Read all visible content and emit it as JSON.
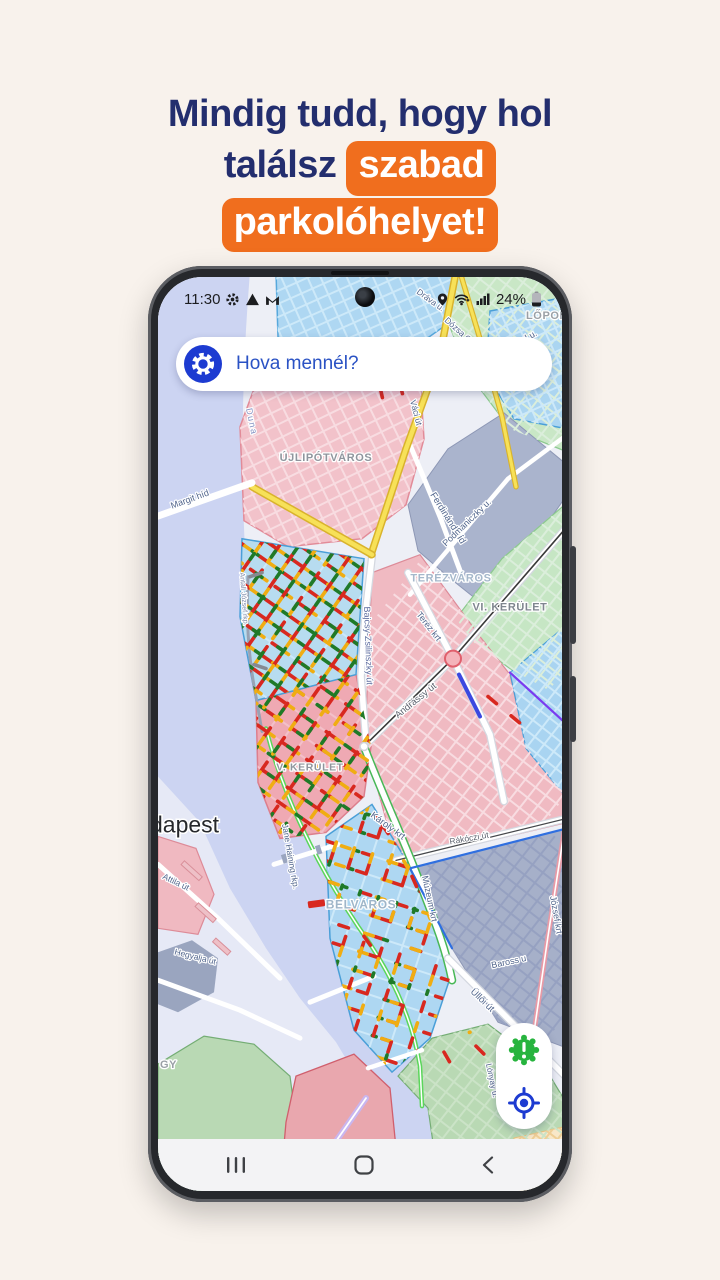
{
  "page": {
    "background": "#f8f2ec"
  },
  "headline": {
    "line1": "Mindig tudd, hogy hol",
    "line2_plain": "találsz",
    "line2_highlight": "szabad",
    "line3_highlight": "parkolóhelyet!",
    "text_color": "#232e6e",
    "highlight_bg": "#f06e1e",
    "highlight_text": "#ffffff"
  },
  "status_bar": {
    "time": "11:30",
    "battery_percent": "24%",
    "left_icons": [
      "gear-icon",
      "warning-icon",
      "gmail-icon"
    ],
    "right_icons": [
      "location-pin-icon",
      "wifi-icon",
      "signal-bars-icon",
      "battery-icon"
    ]
  },
  "search": {
    "placeholder": "Hova mennél?",
    "icon": "settings-gear-icon",
    "accent": "#1d3bd1"
  },
  "map": {
    "city_label": "dapest",
    "water_label": "Duna",
    "districts": [
      "ÚJLIPÓTVÁROS",
      "TERÉZVÁROS",
      "VI. KERÜLET",
      "V. KERÜLET",
      "BELVÁROS",
      "LŐPORT",
      "GY"
    ],
    "streets": [
      "Margit híd",
      "Ferdinánd híd",
      "Lehel u.",
      "Dráva u.",
      "Dózsa Gy",
      "Váci út",
      "Podmaniczky u.",
      "Teréz krt",
      "Andrássy út",
      "Bajcsy-Zsilinszky út",
      "Károly krt",
      "Múzeum krt",
      "Rákóczi út",
      "József krt",
      "Baross u",
      "Üllői út",
      "Attila út",
      "Hegyalja út",
      "Jane Haining rkp.",
      "Lónyay u.",
      "Antall József rkp."
    ],
    "parking_colors": {
      "free": "#1f7a28",
      "limited": "#f0ad12",
      "occupied": "#d8281f"
    }
  },
  "fab": {
    "buttons": [
      {
        "name": "vignette-alert-button",
        "icon": "badge-exclamation-icon",
        "color": "#27b43e"
      },
      {
        "name": "locate-button",
        "icon": "crosshair-locate-icon",
        "color": "#1d3bd1"
      }
    ]
  },
  "nav_bar": {
    "items": [
      "recents",
      "home",
      "back"
    ]
  }
}
